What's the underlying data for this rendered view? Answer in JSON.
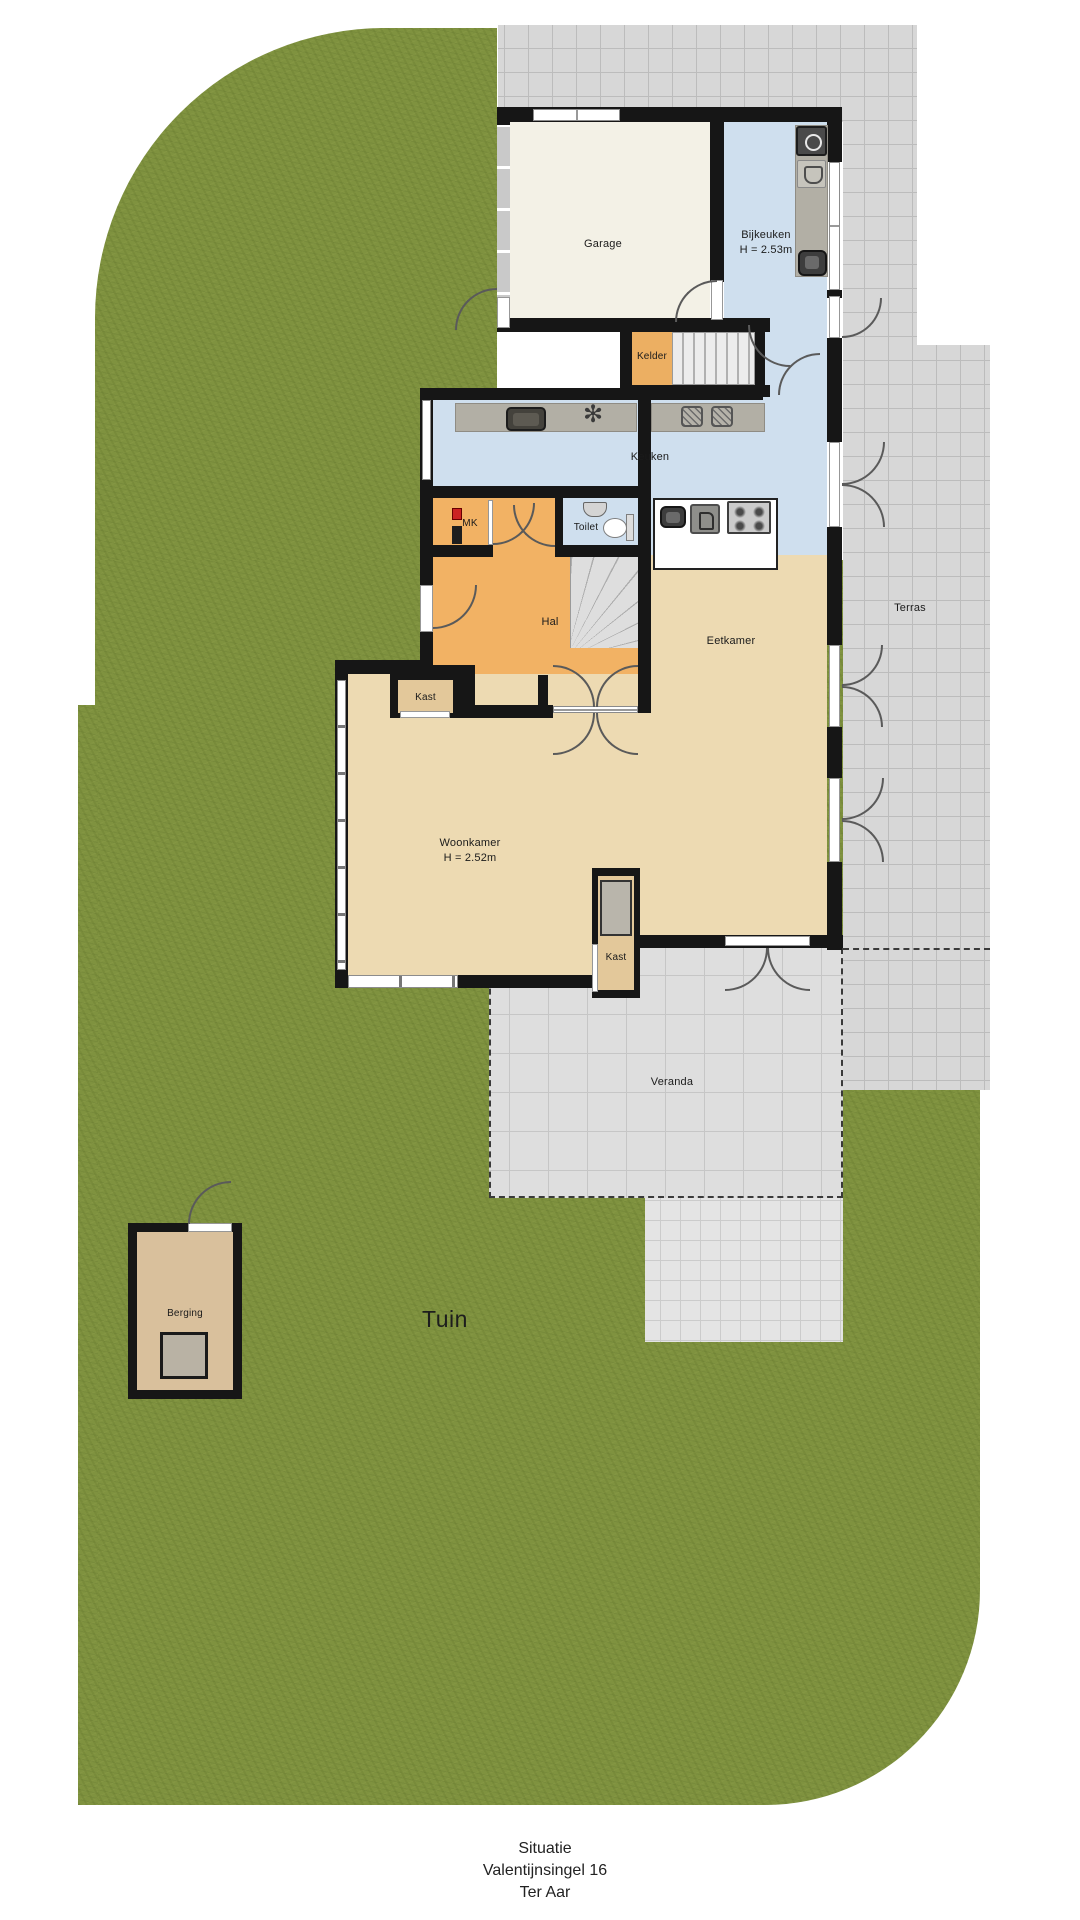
{
  "areas": {
    "tuin": "Tuin",
    "terras": "Terras",
    "veranda": "Veranda"
  },
  "rooms": {
    "garage": {
      "label": "Garage"
    },
    "bijkeuken": {
      "label": "Bijkeuken",
      "height": "H = 2.53m"
    },
    "kelder": {
      "label": "Kelder"
    },
    "keuken": {
      "label": "Keuken"
    },
    "mk": {
      "label": "MK"
    },
    "toilet": {
      "label": "Toilet"
    },
    "hal": {
      "label": "Hal"
    },
    "eetkamer": {
      "label": "Eetkamer"
    },
    "kast_hal": {
      "label": "Kast"
    },
    "woonkamer": {
      "label": "Woonkamer",
      "height": "H = 2.52m"
    },
    "kast_woonkamer": {
      "label": "Kast"
    },
    "berging": {
      "label": "Berging"
    }
  },
  "footer": {
    "line1": "Situatie",
    "line2": "Valentijnsingel 16",
    "line3": "Ter Aar"
  },
  "icons": {
    "star_symbol": "✻"
  },
  "palette": {
    "grass": "#7F923F",
    "terrace_tile": "#D7D7D7",
    "veranda_tile": "#DEDEDE",
    "wall": "#161616",
    "garage_floor": "#F3F1E6",
    "wet_room_floor": "#CFDFEE",
    "hall_floor": "#F2B264",
    "living_floor": "#EDDAB2",
    "berging_floor": "#D9C09C",
    "counter": "#B2AFA5"
  }
}
